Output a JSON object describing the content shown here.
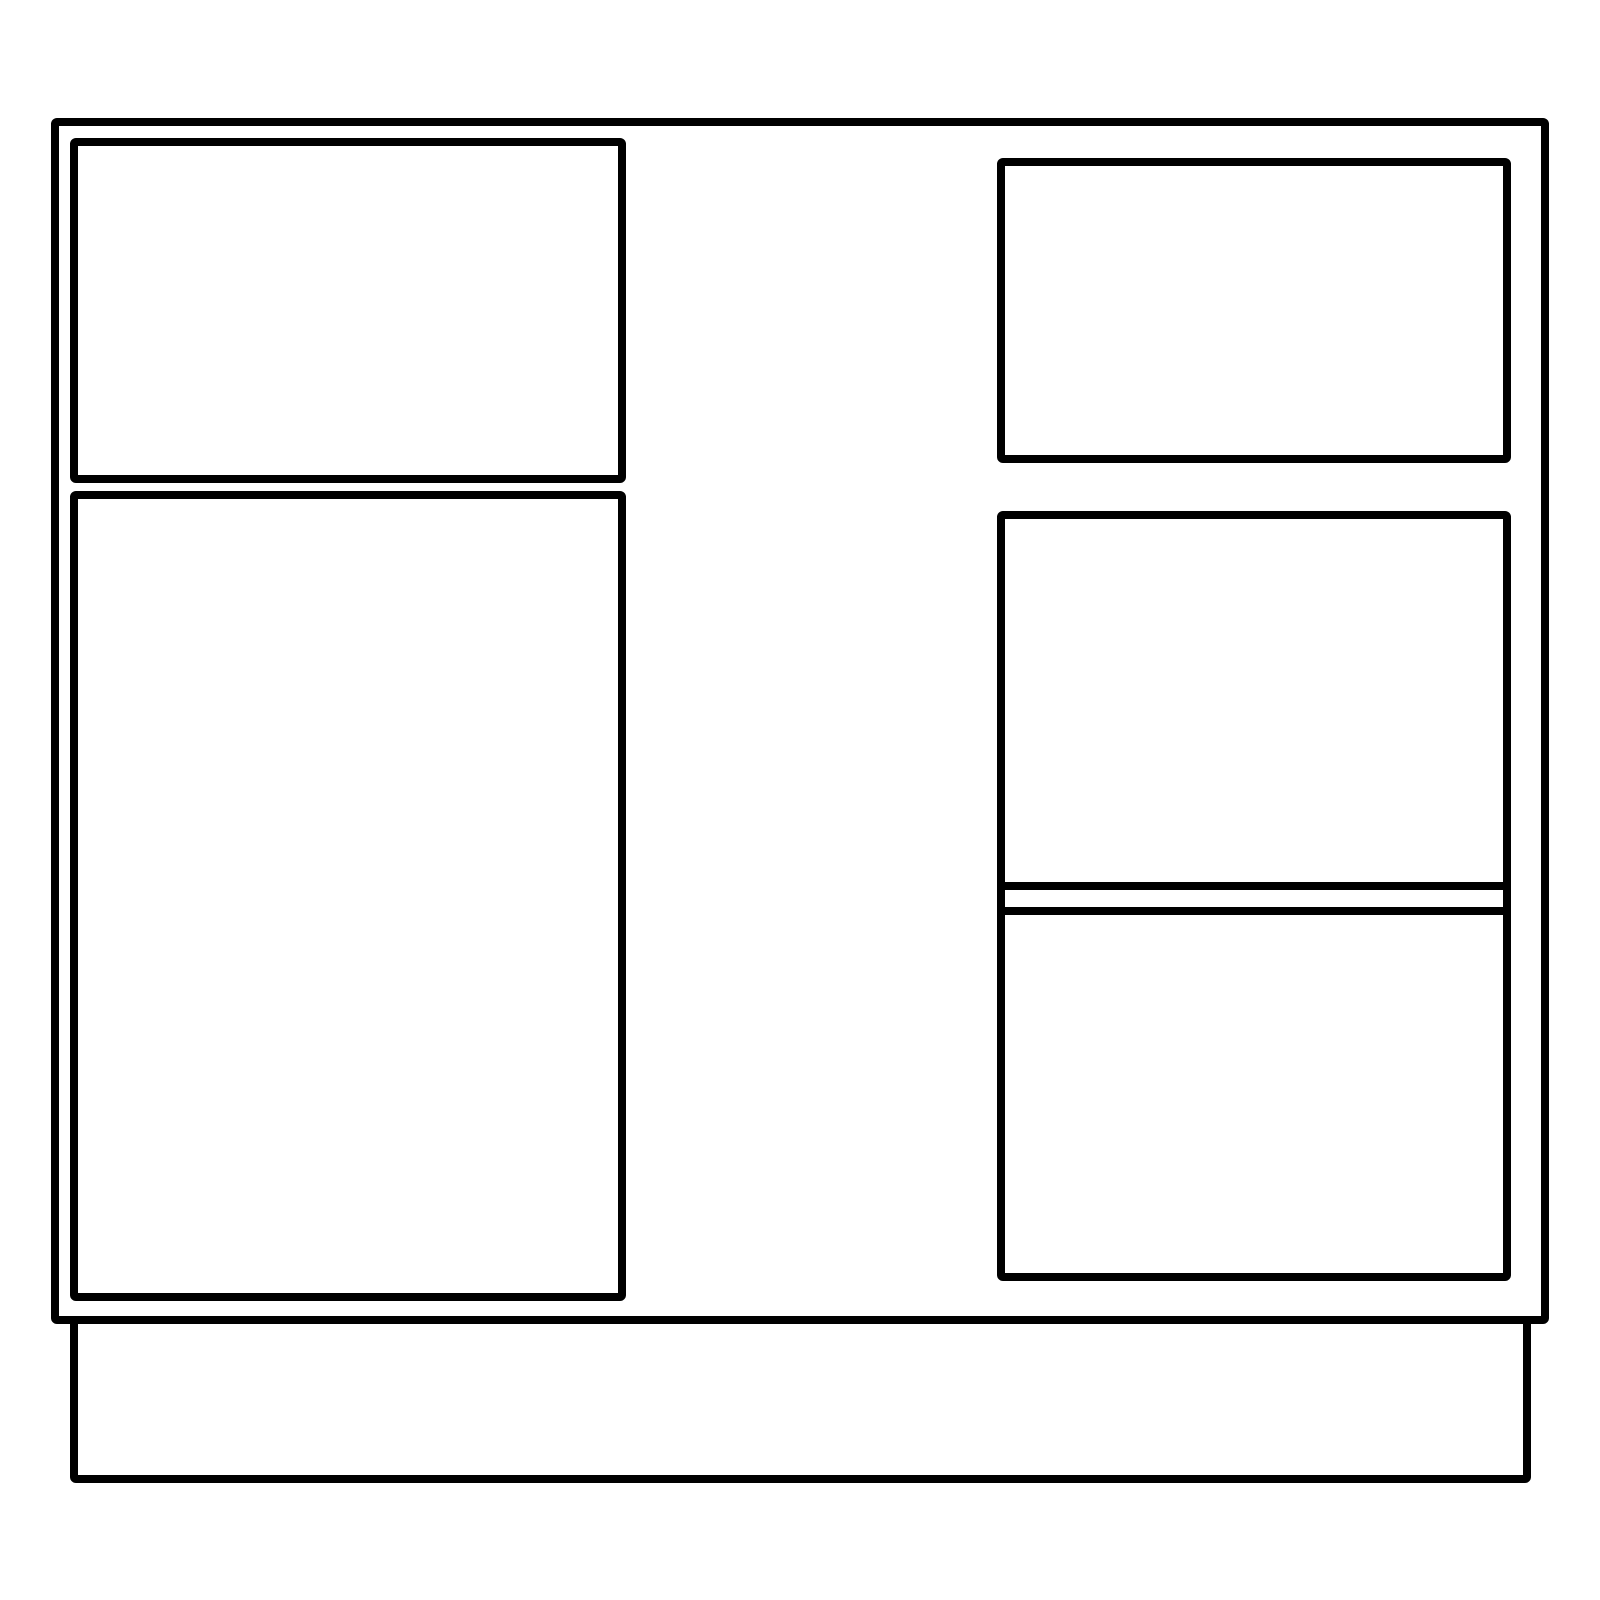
{
  "page": {
    "background": "#ffffff",
    "width": 1600,
    "height": 1600
  },
  "diagram": {
    "title": "cabinet-front-elevation-line-drawing",
    "stroke_color": "#000000",
    "fill_color": "#ffffff",
    "stroke_width": 8,
    "panels": [
      {
        "name": "cabinet-outline",
        "x": 51,
        "y": 118,
        "w": 1498,
        "h": 1206,
        "corner": "rounded"
      },
      {
        "name": "toe-kick-base",
        "x": 70,
        "y": 1316,
        "w": 1461,
        "h": 167,
        "corner": "rounded-bottom"
      },
      {
        "name": "left-drawer-front",
        "x": 70,
        "y": 138,
        "w": 556,
        "h": 345,
        "corner": "rounded"
      },
      {
        "name": "left-door-panel",
        "x": 70,
        "y": 491,
        "w": 556,
        "h": 810,
        "corner": "rounded"
      },
      {
        "name": "right-drawer-front",
        "x": 997,
        "y": 158,
        "w": 514,
        "h": 305,
        "corner": "rounded"
      },
      {
        "name": "right-lower-panel",
        "x": 997,
        "y": 511,
        "w": 514,
        "h": 770,
        "corner": "rounded"
      }
    ],
    "dividers": [
      {
        "name": "right-panel-divider-upper",
        "x": 997,
        "y": 882,
        "w": 514,
        "h": 8
      },
      {
        "name": "right-panel-divider-lower",
        "x": 997,
        "y": 907,
        "w": 514,
        "h": 8
      }
    ]
  }
}
